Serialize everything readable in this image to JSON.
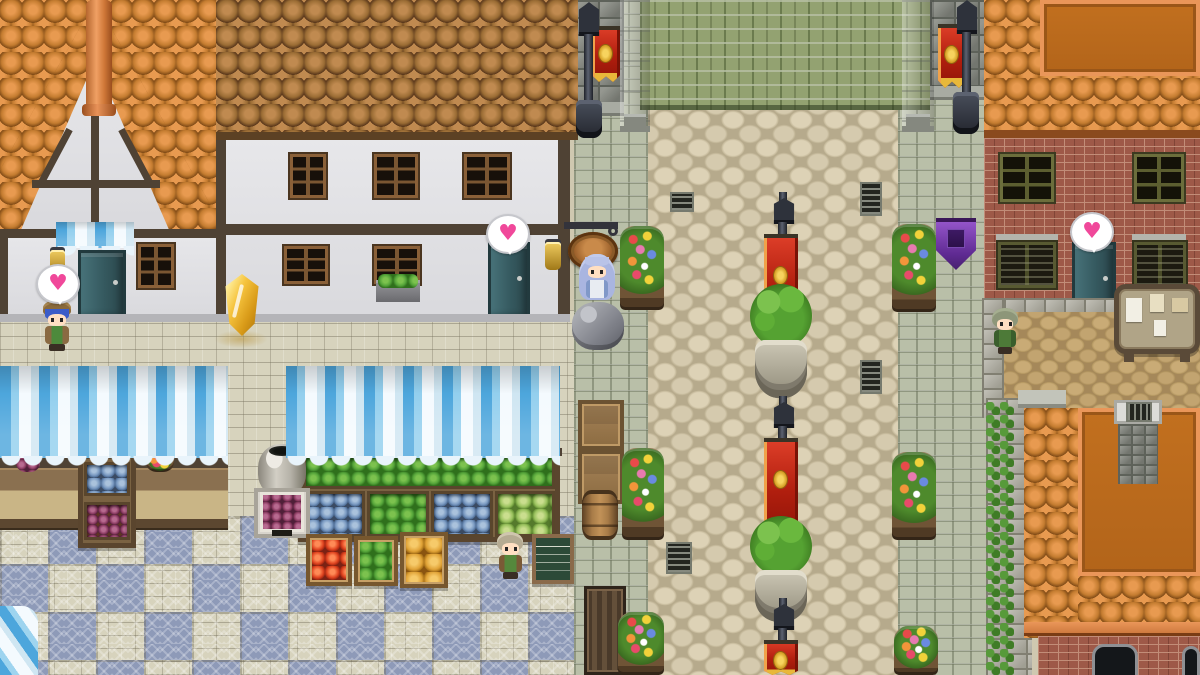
{
  "scene": {
    "name": "medieval-town-market-plaza",
    "type": "top-down-rpg-town-scene",
    "viewport": "1200x675",
    "areas": [
      "tudor-house-left",
      "white-shop-building",
      "green-roof-hall",
      "central-plaza",
      "market-stalls",
      "brick-house-right",
      "orange-roof-house-bottom-right"
    ]
  },
  "bubbles": {
    "glyph": "♥",
    "color": "#f0489a",
    "count": 3,
    "locations": [
      "above-boy-left",
      "above-center-building-door",
      "above-right-building-door"
    ]
  },
  "npcs": [
    {
      "id": "boy-blue-hair",
      "location": "market-left",
      "hair_color": "#3b5cc8",
      "outfit_color": "#4d8a3c"
    },
    {
      "id": "woman-long-blue-hair",
      "location": "shop-front-center",
      "hair_color": "#a9b5e0",
      "outfit_color": "#e8ecf2"
    },
    {
      "id": "shopkeeper",
      "location": "market-bottom",
      "hair_color": "#b5ab92",
      "outfit_color": "#55883c"
    },
    {
      "id": "villager-woman",
      "location": "right-street",
      "hair_color": "#8d9679",
      "outfit_color": "#4d7a38"
    }
  ],
  "props": {
    "gold_crystal": {
      "color": "#f5c33a"
    },
    "red_banners": 5,
    "purple_banners": 1,
    "lamp_posts": 5,
    "topiary_planters": 2,
    "flower_stands": 6,
    "drain_grates": 4,
    "market_goods": [
      "tomatoes",
      "greens",
      "pumpkins",
      "plums",
      "jars",
      "cabbage",
      "pots"
    ],
    "signs": [
      "hanging-round-shop-sign",
      "chalkboard-menu",
      "notice-board"
    ]
  },
  "palette": {
    "roof_orange": "#c47c30",
    "roof_orange_flat": "#bc6a1e",
    "roof_brown": "#9a6c34",
    "roof_green": "#93a271",
    "wall_white": "#e7e7ea",
    "timber": "#4f4234",
    "brick_red": "#9e5948",
    "plaza_cobble": "#d5cab0",
    "street_stone": "#b9bfa8",
    "ground_brick": "#d7d3bd",
    "mosaic_blue": "#8e9ab8",
    "awning_blue": "#4da6dc",
    "door_teal": "#35595f",
    "banner_red": "#c52413",
    "banner_gold": "#e8b83a",
    "banner_purple": "#7a3fae",
    "bush_green": "#55a232",
    "heart_pink": "#f0489a",
    "crystal_gold": "#f5c33a"
  }
}
